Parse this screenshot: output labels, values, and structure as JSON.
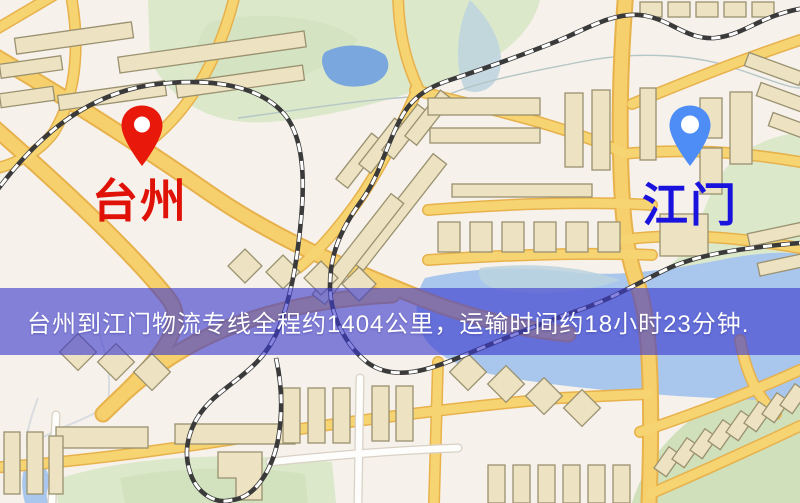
{
  "banner": {
    "text": "台州到江门物流专线全程约1404公里，运输时间约18小时23分钟.",
    "background_color": "rgba(60,58,205,0.62)",
    "text_color": "#ffffff"
  },
  "markers": {
    "origin": {
      "label": "台州",
      "pin_color": "#e8190b",
      "label_color": "#e01207"
    },
    "destination": {
      "label": "江门",
      "pin_color": "#4e8df6",
      "label_color": "#1a12dd"
    }
  },
  "map": {
    "style": "road-map",
    "colors": {
      "background": "#f6f1ea",
      "road": "#f6d06c",
      "road_casing": "#e7b14b",
      "park": "#dbe8ca",
      "water": "#a9c6ed",
      "building": "#ede2c2",
      "railway": "#3a3a3a",
      "lake": "#79a7de"
    }
  }
}
